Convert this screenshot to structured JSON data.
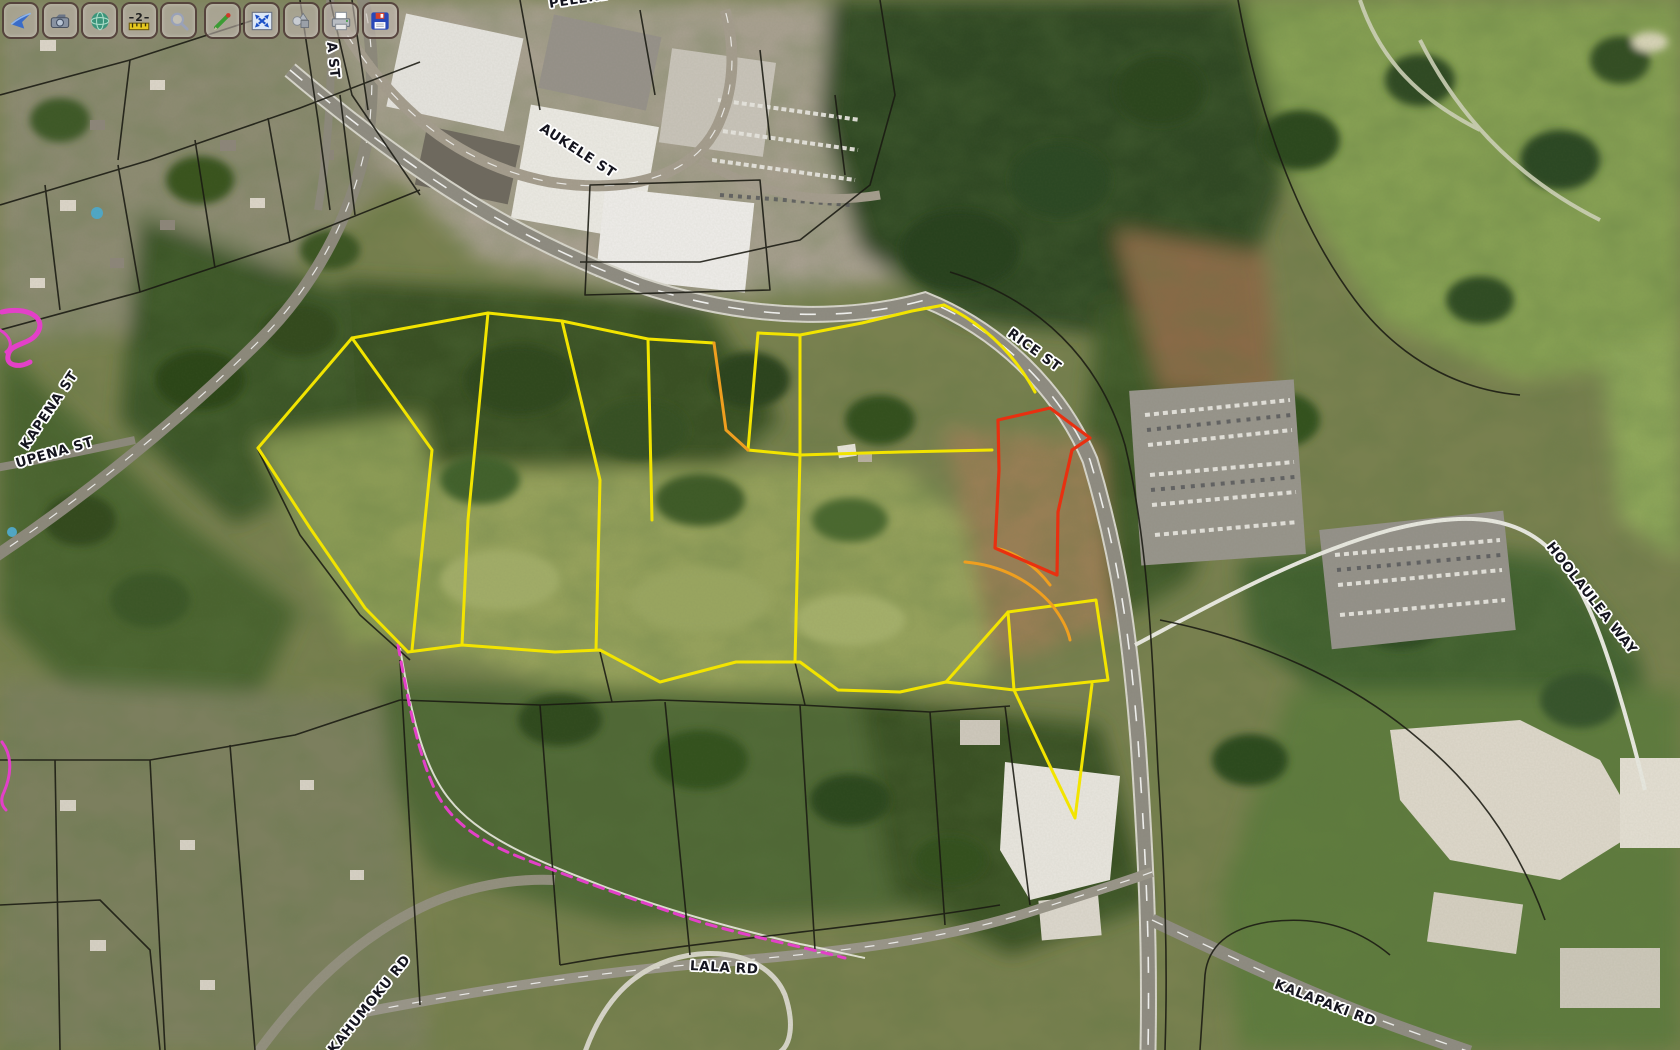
{
  "app": {
    "type": "aerial-parcel-map-viewer"
  },
  "toolbar": {
    "buttons": [
      {
        "icon": "swoosh-navigate-icon"
      },
      {
        "icon": "camera-icon"
      },
      {
        "icon": "globe-icon"
      },
      {
        "icon": "measure-icon"
      },
      {
        "icon": "magnifier-icon"
      },
      {
        "icon": "pencil-draw-icon"
      },
      {
        "icon": "zoom-extent-icon"
      },
      {
        "icon": "shapes-icon"
      },
      {
        "icon": "printer-icon"
      },
      {
        "icon": "floppy-save-icon"
      }
    ]
  },
  "map": {
    "street_labels": [
      {
        "text": "PELEKE ST"
      },
      {
        "text": "A ST"
      },
      {
        "text": "AUKELE ST"
      },
      {
        "text": "RICE ST"
      },
      {
        "text": "KAPENA ST"
      },
      {
        "text": "UPENA ST"
      },
      {
        "text": "HOOLAULEA WAY"
      },
      {
        "text": "LALA RD"
      },
      {
        "text": "KALAPAKI RD"
      },
      {
        "text": "KAHUMOKU RD"
      }
    ],
    "colors": {
      "parcel_line": "#1a1a12",
      "parcel_highlight": "#f2e400",
      "parcel_selected": "#e83010",
      "parcel_curve": "#ef9f1f",
      "easement_line": "#e340c8",
      "road_label_text": "#15151f",
      "road_label_halo": "#ffffff"
    }
  }
}
